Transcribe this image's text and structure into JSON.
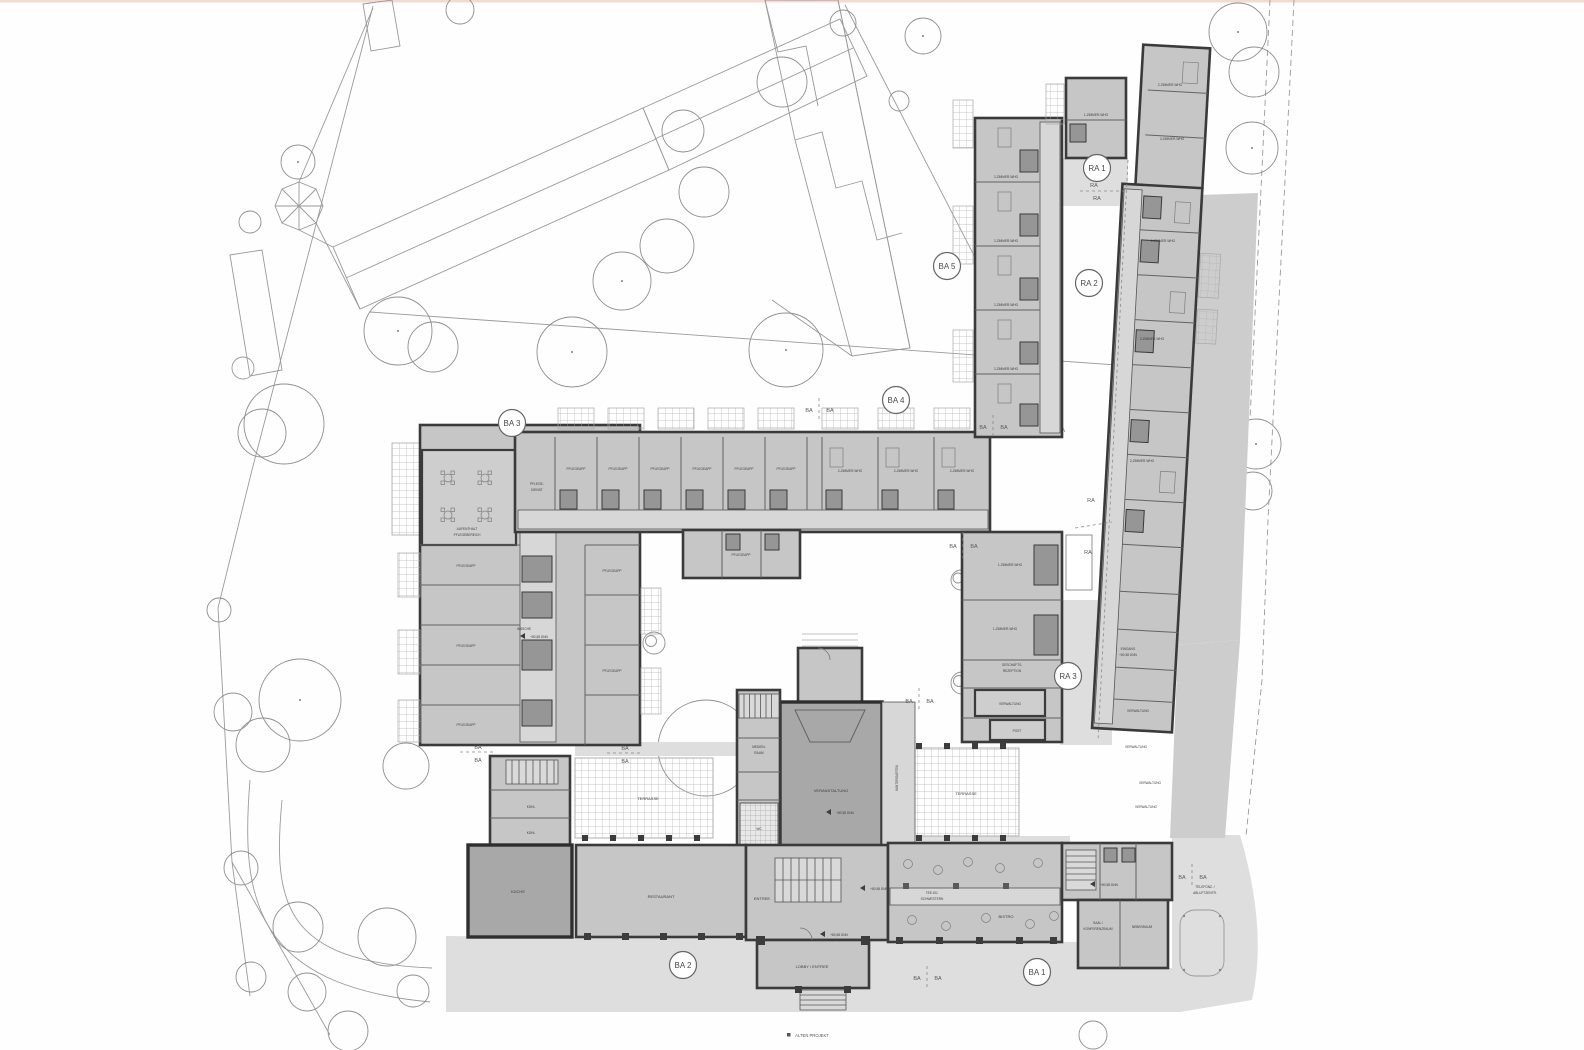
{
  "caption": "ALTEN PROJEKT",
  "zones": {
    "ba1": "BA 1",
    "ba2": "BA 2",
    "ba3": "BA 3",
    "ba4": "BA 4",
    "ba5": "BA 5",
    "ra1": "RA 1",
    "ra2": "RA 2",
    "ra3": "RA 3"
  },
  "markers": {
    "ba": "BA",
    "ra": "RA"
  },
  "rooms": {
    "aufenthalt_l1": "AUFENTHALT",
    "aufenthalt_l2": "PFLEGEBEREICH",
    "pflegeapp": "PFLEGEAPP",
    "pflegedienst_l1": "PFLEGE-",
    "pflegedienst_l2": "DIENST",
    "waesche": "WÄSCHE",
    "whg1": "1-ZIMMER-WHG",
    "whg2": "2-ZIMMER-WHG",
    "whg3": "3-ZIMMER-WHG",
    "veranstaltung": "VERANSTALTUNG",
    "wintergarten": "WINTERGARTEN",
    "medienraum_l1": "MEDIEN-",
    "medienraum_l2": "RAUM",
    "wc": "WC",
    "terrasse": "TERRASSE",
    "restaurant": "RESTAURANT",
    "kueche": "KÜCHE",
    "kuehl": "KÜHL",
    "entree": "ENTREE",
    "lobby": "LOBBY / ENTREE",
    "bistro": "BISTRO",
    "teekueche_l1": "TEE-KÜ.",
    "teekueche_l2": "SCHWESTERN",
    "saal_l1": "SAAL /",
    "saal_l2": "KONFERENZRAUM",
    "nebenraum": "NEBENRAUM",
    "verwaltung": "VERWALTUNG",
    "rezeption_l1": "GESCHÄFTS-",
    "rezeption_l2": "REZEPTION",
    "post": "POST",
    "eingang_l1": "EINGANG",
    "eingang_l2": "+80,58 ÜNN",
    "telefon_l1": "TELEFONZ. /",
    "telefon_l2": "ABLUFTZENTR.",
    "level": "+80,58 ÜNN"
  },
  "colors": {
    "wall": "#3a3a3a",
    "room": "#c6c6c6",
    "room_dark": "#a8a8a8",
    "corridor": "#d7d7d7",
    "ground": "#dedede",
    "context_line": "#9a9a9a"
  }
}
